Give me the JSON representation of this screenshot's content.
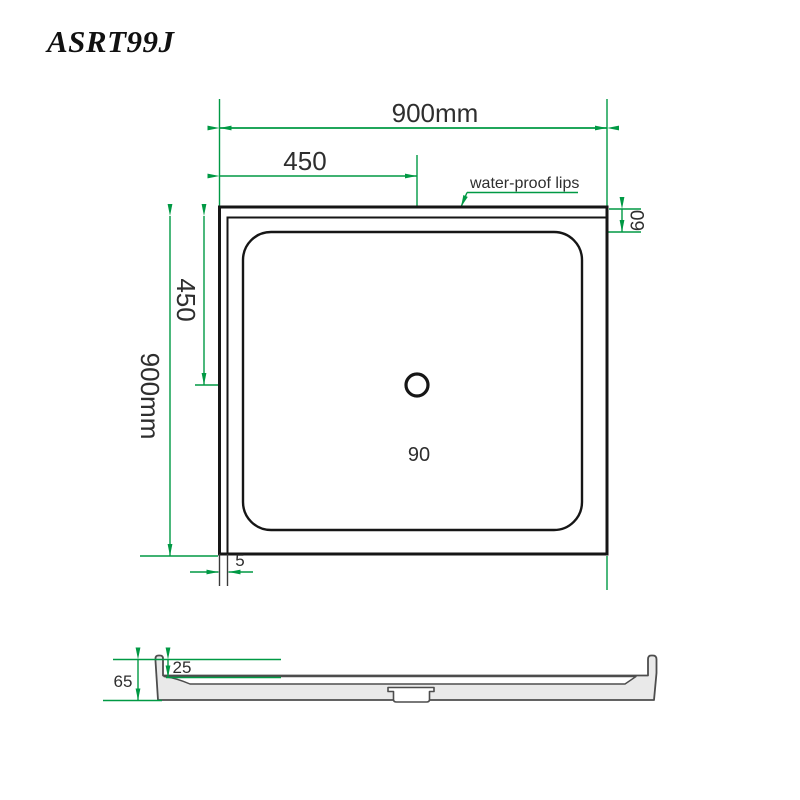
{
  "title": "ASRT99J",
  "top_view": {
    "width_label": "900mm",
    "half_width_label": "450",
    "height_label": "900mm",
    "half_height_label": "450",
    "rim_width_label": "60",
    "drain_diameter_label": "90",
    "lip_thickness_label": "5",
    "lips_note": "water-proof lips"
  },
  "section_view": {
    "total_height_label": "65",
    "lip_depth_label": "25"
  },
  "colors": {
    "dimension_green": "#009944",
    "drawing_black": "#161616",
    "section_fill_gray": "#e9e9e9",
    "section_outline_gray": "#4d4d4d"
  }
}
